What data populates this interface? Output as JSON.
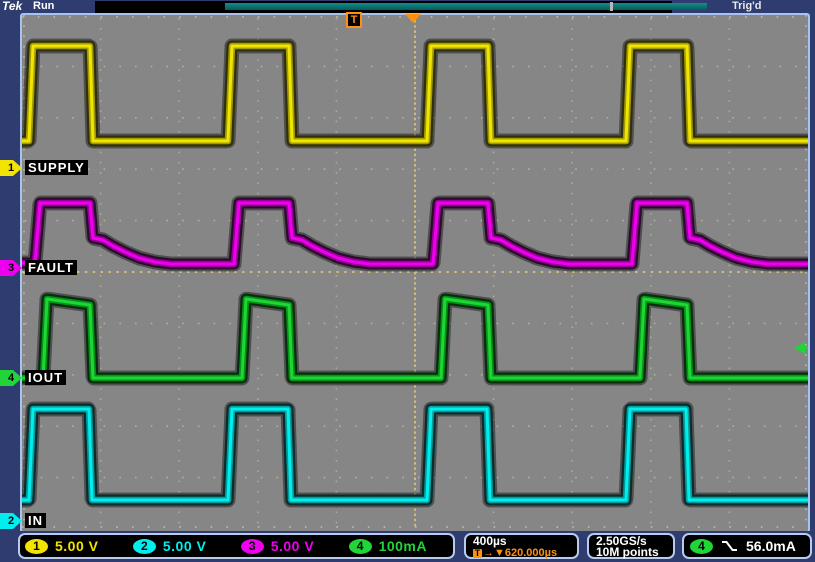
{
  "titlebar": {
    "logo": "Tek",
    "acq_status": "Run",
    "trig_status": "Trig'd",
    "trigger_marker_label": "T"
  },
  "colors": {
    "ch1": "#f2e400",
    "ch1_mid": "#a09c00",
    "ch1_dark": "#32300a",
    "ch2": "#00eeee",
    "ch2_mid": "#009c9c",
    "ch2_dark": "#0a2c2c",
    "ch3": "#ee00ee",
    "ch3_mid": "#9c009c",
    "ch3_dark": "#2c0a2c",
    "ch4": "#21d437",
    "ch4_mid": "#009614",
    "ch4_dark": "#0a2c0e",
    "accent_orange": "#ff9010",
    "graticule_dot": "#ded8b2",
    "graticule_center": "#d2c27c"
  },
  "channels": [
    {
      "id": "1",
      "name": "SUPPLY",
      "color_key": "ch1",
      "marker_y": 168
    },
    {
      "id": "3",
      "name": "FAULT",
      "color_key": "ch3",
      "marker_y": 268
    },
    {
      "id": "4",
      "name": "IOUT",
      "color_key": "ch4",
      "marker_y": 378
    },
    {
      "id": "2",
      "name": "IN",
      "color_key": "ch2",
      "marker_y": 521
    }
  ],
  "bottom": {
    "channel_readouts": [
      {
        "ch": "1",
        "color_key": "ch1",
        "scale": "5.00 V"
      },
      {
        "ch": "2",
        "color_key": "ch2",
        "scale": "5.00 V"
      },
      {
        "ch": "3",
        "color_key": "ch3",
        "scale": "5.00 V"
      },
      {
        "ch": "4",
        "color_key": "ch4",
        "scale": "100mA"
      }
    ],
    "timebase": "400µs",
    "trigger_delay_prefix": "T",
    "trigger_delay": "→▼620.000µs",
    "sample_rate": "2.50GS/s",
    "record_length": "10M points",
    "trigger": {
      "ch": "4",
      "color_key": "ch4",
      "slope": "falling",
      "level": "56.0mA"
    }
  },
  "chart_data": {
    "type": "line",
    "instrument": "oscilloscope",
    "title": "4-channel acquisition: SUPPLY / FAULT / IOUT / IN",
    "x_axis": {
      "time_per_div": "400µs",
      "divisions": 10,
      "trigger_delay": "620.000µs"
    },
    "y_axis": {
      "divisions": 10,
      "scales": {
        "ch1": "5.00 V/div",
        "ch2": "5.00 V/div",
        "ch3": "5.00 V/div",
        "ch4": "100mA/div"
      }
    },
    "trigger": {
      "source": "CH4",
      "slope": "falling",
      "level": "56.0mA",
      "position_px_x": 414,
      "level_px_y": 348
    },
    "period_us_approx": 1010,
    "channels": [
      {
        "ch": 1,
        "label": "SUPPLY",
        "color_key": "ch1",
        "waveform": "square",
        "high_time_us_approx": 310,
        "points_px": [
          [
            22,
            141
          ],
          [
            29,
            141
          ],
          [
            33,
            46
          ],
          [
            90,
            46
          ],
          [
            93,
            141
          ],
          [
            228,
            141
          ],
          [
            232,
            46
          ],
          [
            289,
            46
          ],
          [
            292,
            141
          ],
          [
            427,
            141
          ],
          [
            431,
            46
          ],
          [
            488,
            46
          ],
          [
            491,
            141
          ],
          [
            626,
            141
          ],
          [
            630,
            46
          ],
          [
            687,
            46
          ],
          [
            690,
            141
          ],
          [
            808,
            141
          ]
        ]
      },
      {
        "ch": 3,
        "label": "FAULT",
        "color_key": "ch3",
        "waveform": "pulse-with-decay",
        "points_px": [
          [
            22,
            263
          ],
          [
            35,
            263
          ],
          [
            40,
            203
          ],
          [
            90,
            203
          ],
          [
            93,
            238
          ],
          [
            103,
            240
          ],
          [
            113,
            246
          ],
          [
            125,
            252
          ],
          [
            139,
            258
          ],
          [
            155,
            262
          ],
          [
            171,
            264
          ],
          [
            234,
            264
          ],
          [
            239,
            203
          ],
          [
            289,
            203
          ],
          [
            292,
            238
          ],
          [
            302,
            240
          ],
          [
            312,
            246
          ],
          [
            324,
            252
          ],
          [
            338,
            258
          ],
          [
            354,
            262
          ],
          [
            370,
            264
          ],
          [
            433,
            264
          ],
          [
            438,
            203
          ],
          [
            488,
            203
          ],
          [
            491,
            238
          ],
          [
            501,
            240
          ],
          [
            511,
            246
          ],
          [
            523,
            252
          ],
          [
            537,
            258
          ],
          [
            553,
            262
          ],
          [
            569,
            264
          ],
          [
            632,
            264
          ],
          [
            637,
            203
          ],
          [
            687,
            203
          ],
          [
            690,
            238
          ],
          [
            700,
            240
          ],
          [
            710,
            246
          ],
          [
            722,
            252
          ],
          [
            736,
            258
          ],
          [
            752,
            262
          ],
          [
            768,
            264
          ],
          [
            808,
            264
          ]
        ]
      },
      {
        "ch": 4,
        "label": "IOUT",
        "color_key": "ch4",
        "waveform": "pulse",
        "points_px": [
          [
            22,
            378
          ],
          [
            43,
            378
          ],
          [
            47,
            299
          ],
          [
            90,
            305
          ],
          [
            93,
            378
          ],
          [
            242,
            378
          ],
          [
            246,
            299
          ],
          [
            289,
            305
          ],
          [
            292,
            378
          ],
          [
            441,
            378
          ],
          [
            445,
            299
          ],
          [
            488,
            305
          ],
          [
            491,
            378
          ],
          [
            640,
            378
          ],
          [
            644,
            299
          ],
          [
            687,
            305
          ],
          [
            690,
            378
          ],
          [
            808,
            378
          ]
        ]
      },
      {
        "ch": 2,
        "label": "IN",
        "color_key": "ch2",
        "waveform": "square",
        "points_px": [
          [
            22,
            500
          ],
          [
            29,
            500
          ],
          [
            33,
            409
          ],
          [
            89,
            409
          ],
          [
            92,
            500
          ],
          [
            228,
            500
          ],
          [
            232,
            409
          ],
          [
            288,
            409
          ],
          [
            291,
            500
          ],
          [
            427,
            500
          ],
          [
            431,
            409
          ],
          [
            487,
            409
          ],
          [
            490,
            500
          ],
          [
            626,
            500
          ],
          [
            630,
            409
          ],
          [
            686,
            409
          ],
          [
            689,
            500
          ],
          [
            808,
            500
          ]
        ]
      }
    ]
  }
}
